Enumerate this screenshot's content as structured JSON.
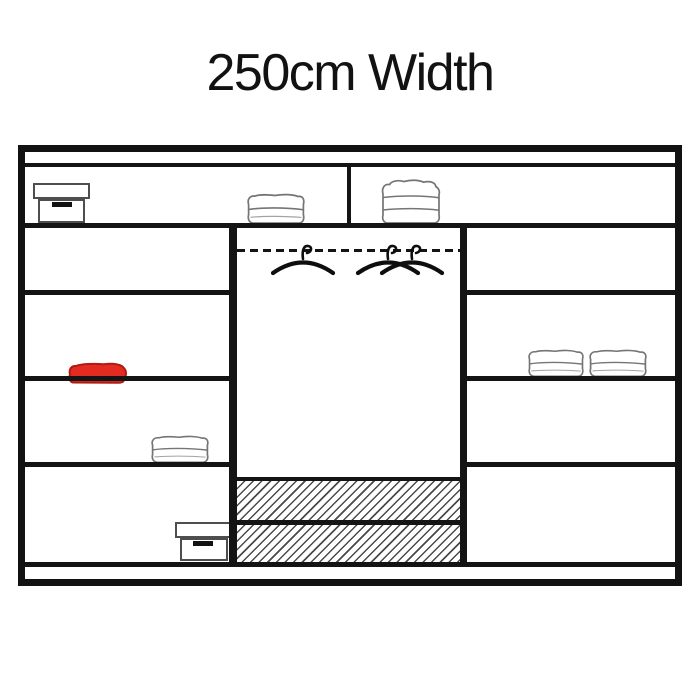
{
  "title": "250cm Width",
  "diagram": {
    "name": "wardrobe-interior-diagram",
    "width_label": "250cm",
    "colors": {
      "outline": "#121212",
      "item_sketch": "#757575",
      "red_towel_fill": "#e32b22",
      "red_towel_border": "#b21a10",
      "hatch_line": "#4a4a4a"
    },
    "items": [
      {
        "name": "storage-box",
        "location": "top-shelf-left"
      },
      {
        "name": "folded-towel",
        "location": "top-shelf-center"
      },
      {
        "name": "folded-towel",
        "location": "top-shelf-right"
      },
      {
        "name": "clothes-hangers",
        "location": "middle-hanging-rail",
        "count": 3
      },
      {
        "name": "folded-towel-red",
        "location": "left-column-middle-shelf"
      },
      {
        "name": "folded-towel",
        "location": "left-column-lower-shelf"
      },
      {
        "name": "storage-box",
        "location": "left-column-bottom"
      },
      {
        "name": "folded-towel",
        "location": "right-column-middle-shelf",
        "count": 2
      },
      {
        "name": "hatched-drawer",
        "location": "middle-column-bottom",
        "count": 2
      }
    ]
  }
}
